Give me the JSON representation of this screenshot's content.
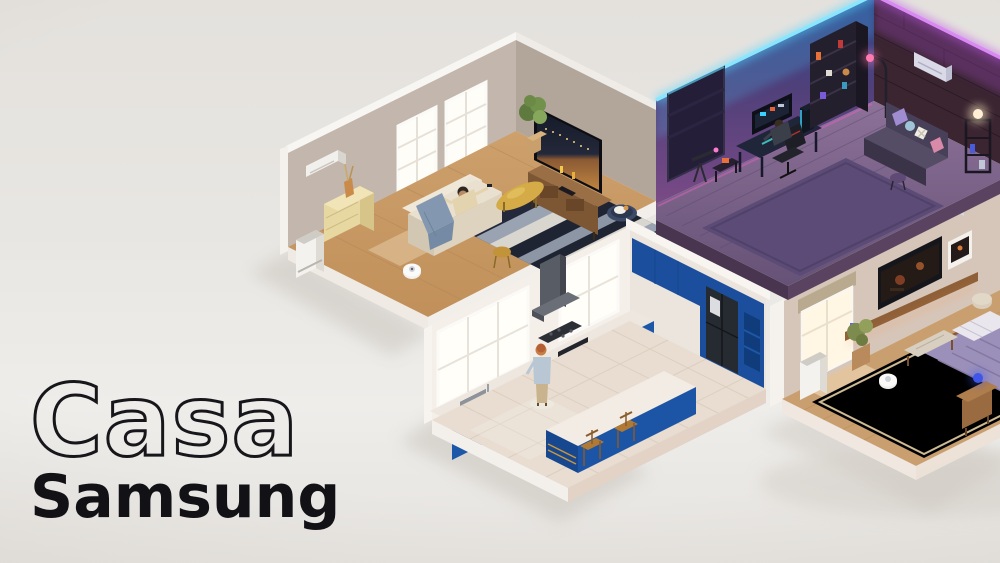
{
  "logo": {
    "line1": "Casa",
    "line2": "Samsung"
  },
  "palette": {
    "background": "#e8e6e2",
    "logo_ink": "#17171b",
    "living_wall": "#c2b5ab",
    "living_floor": "#c79b67",
    "gaming_wall_top": "#2e4a8c",
    "gaming_wall_bottom": "#7a4a86",
    "gaming_led_cyan": "#55d8ff",
    "gaming_led_magenta": "#c05ae8",
    "gaming_floor": "#7a6490",
    "brick_wall": "#3a2531",
    "kitchen_wall": "#f3eee8",
    "kitchen_cabinet_blue": "#1c56a7",
    "kitchen_floor": "#e8ddd0",
    "bedroom_wall": "#d6c6b9",
    "bedroom_floor": "#c99f6f",
    "bedroom_rug": "#dbc9a3",
    "sofa_cream": "#e6ddcb",
    "blanket_blue": "#8398b0"
  },
  "scene": {
    "type": "isometric-cutaway-smart-home",
    "rooms": [
      {
        "name": "living-room",
        "position": "top-left",
        "items": [
          "air-conditioner",
          "window",
          "dresser",
          "vase",
          "air-purifier",
          "sofa",
          "person-watching-tv",
          "blanket",
          "striped-rug",
          "coffee-table",
          "side-stool",
          "tv-basketball",
          "tv-stand",
          "potted-plant",
          "robot-vacuum",
          "pet-bed",
          "cat"
        ]
      },
      {
        "name": "gaming-room",
        "position": "top-right",
        "items": [
          "led-strip",
          "blackout-shade-window",
          "gaming-desk",
          "ultrawide-monitor",
          "pc-tower",
          "gaming-chair",
          "person-gaming",
          "bookshelf",
          "floor-lamp",
          "air-conditioner",
          "sofa",
          "cushions",
          "stool",
          "shelf-lamp",
          "telescope",
          "rug",
          "brick-wall"
        ]
      },
      {
        "name": "kitchen",
        "position": "bottom-center",
        "items": [
          "window",
          "range-hood",
          "gas-cooktop",
          "wall-oven",
          "sink",
          "faucet",
          "dishwasher",
          "blue-cabinets",
          "refrigerator",
          "open-shelves",
          "island",
          "bar-stool",
          "person-cooking",
          "step-mat"
        ]
      },
      {
        "name": "bedroom",
        "position": "bottom-right",
        "items": [
          "air-conditioner",
          "roller-shade-window",
          "wall-tv",
          "framed-art",
          "floating-shelf",
          "potted-plant",
          "air-purifier",
          "rug",
          "robot-vacuum",
          "bed",
          "purple-duvet",
          "bench",
          "nightstand",
          "glow-lamp",
          "pouf"
        ]
      }
    ]
  }
}
